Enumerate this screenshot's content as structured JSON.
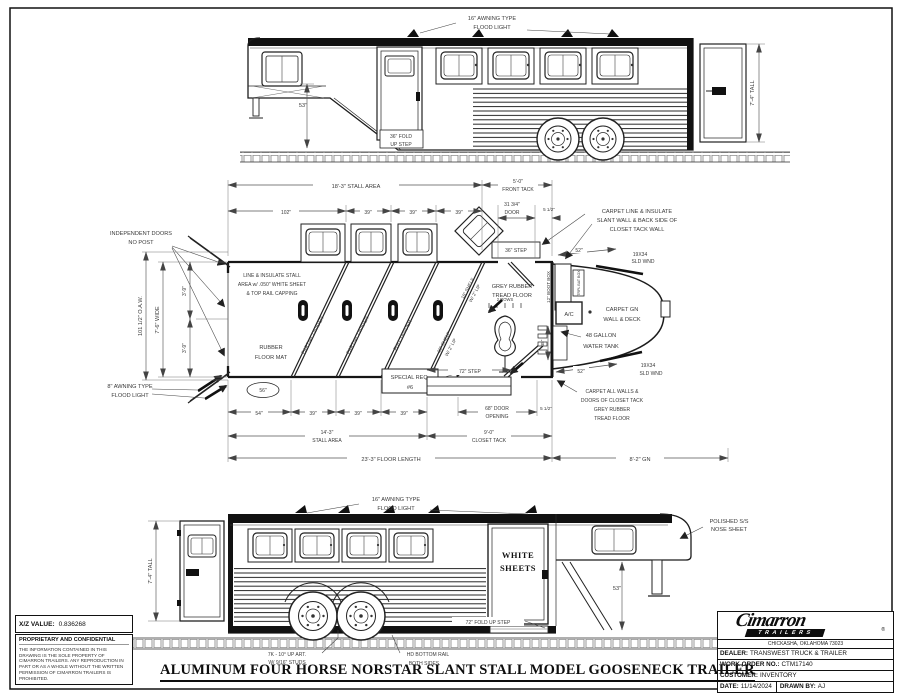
{
  "top_view": {
    "flood_light": [
      "16\" AWNING TYPE",
      "FLOOD LIGHT"
    ],
    "dim_53": "53\"",
    "fold_step": [
      "36\" FOLD",
      "UP STEP"
    ],
    "tall": "7'-4\" TALL"
  },
  "plan": {
    "dims": {
      "stall_area_top": "18'-3\" STALL AREA",
      "front_tack": [
        "5'-0\"",
        "FRONT TACK"
      ],
      "d102": "102\"",
      "d39": "39\"",
      "door": [
        "31 3/4\"",
        "DOOR"
      ],
      "d5h": "5 1/2\"",
      "d52": "52\"",
      "wnd": [
        "19X34",
        "SLD WND"
      ],
      "oaw": "101 1/2\" O.A.W.",
      "wide": "7'-6\" WIDE",
      "d39ft": "3'-9\"",
      "d56": "56\"",
      "d54": "54\"",
      "d38": "38\"",
      "step72": "72\" STEP",
      "step36": "36\" STEP",
      "door_opening": [
        "68\" DOOR",
        "OPENING"
      ],
      "stall_area_bottom": [
        "14'-3\"",
        "STALL AREA"
      ],
      "closet_tack": [
        "9'-0\"",
        "CLOSET TACK"
      ],
      "floor_length": "23'-3\" FLOOR LENGTH",
      "gn": "8'-2\" GN"
    },
    "labels": {
      "independent_doors": [
        "INDEPENDENT DOORS",
        "NO POST"
      ],
      "line_insulate": [
        "LINE & INSULATE STALL",
        "AREA w/ .050\" WHITE SHEET",
        "& TOP RAIL CAPPING"
      ],
      "carpet_line": [
        "CARPET LINE & INSULATE",
        "SLANT WALL & BACK SIDE OF",
        "CLOSET TACK WALL"
      ],
      "rubber_mat": [
        "RUBBER",
        "FLOOR MAT"
      ],
      "awning8": [
        "8\" AWNING TYPE",
        "FLOOD LIGHT"
      ],
      "partial_divider": "PARTIAL DIVIDER",
      "full_divider": "FULL DIVIDER",
      "shelf": [
        "18\" SHELF",
        "W/ 2\" LIP"
      ],
      "special_req": [
        "SPECIAL REQ.",
        "#6"
      ],
      "grey_rubber": [
        "GREY RUBBER",
        "TREAD FLOOR"
      ],
      "two_rows": "2 ROWS",
      "boot_box": "12\" BOOT BOX",
      "bat_box": "TRPL BAT BOX",
      "ac": "A/C",
      "carpet_gn": [
        "CARPET GN",
        "WALL & DECK"
      ],
      "water_tank": [
        "48 GALLON",
        "WATER TANK"
      ],
      "carpet_all": [
        "CARPET ALL WALLS &",
        "DOORS OF CLOSET TACK",
        "GREY RUBBER",
        "TREAD FLOOR"
      ]
    }
  },
  "bottom_view": {
    "flood_light": [
      "16\" AWNING TYPE",
      "FLOOD LIGHT"
    ],
    "tall": "7'-4\" TALL",
    "white_sheets": [
      "WHITE",
      "SHEETS"
    ],
    "fold_step": "72\" FOLD UP STEP",
    "nose": [
      "POLISHED S/S",
      "NOSE SHEET"
    ],
    "dim_53": "53\"",
    "studs": [
      "7K - 10° UP ART.",
      "W/ 9/16\" STUDS"
    ],
    "bottom_rail": [
      "HD BOTTOM RAIL",
      "BOTH SIDES"
    ]
  },
  "main_title": "ALUMINUM FOUR HORSE NORSTAR SLANT STALL MODEL GOOSENECK TRAILER",
  "info_block": {
    "xz_label": "X/Z VALUE:",
    "xz_value": "0.836268",
    "confidential_title": "PROPRIETARY AND CONFIDENTIAL",
    "confidential_text": "THE INFORMATION CONTAINED IN THIS DRAWING IS THE SOLE PROPERTY OF CIMARRON TRAILERS.  ANY REPRODUCTION IN PART OR AS A WHOLE WITHOUT THE WRITTEN PERMIS­SION OF CIMARRON TRAILERS IS PROHIBITED."
  },
  "title_block": {
    "brand": "Cimarron",
    "brand_sub": "TRAILERS",
    "reg": "®",
    "address": "CHICKASHA, OKLAHOMA 73023",
    "dealer_label": "DEALER:",
    "dealer_value": "TRANSWEST TRUCK & TRAILER",
    "wo_label": "WORK ORDER NO.:",
    "wo_value": "CTM17140",
    "customer_label": "CUSTOMER:",
    "customer_value": "INVENTORY",
    "date_label": "DATE:",
    "date_value": "11/14/2024",
    "drawn_label": "DRAWN BY:",
    "drawn_value": "AJ"
  }
}
